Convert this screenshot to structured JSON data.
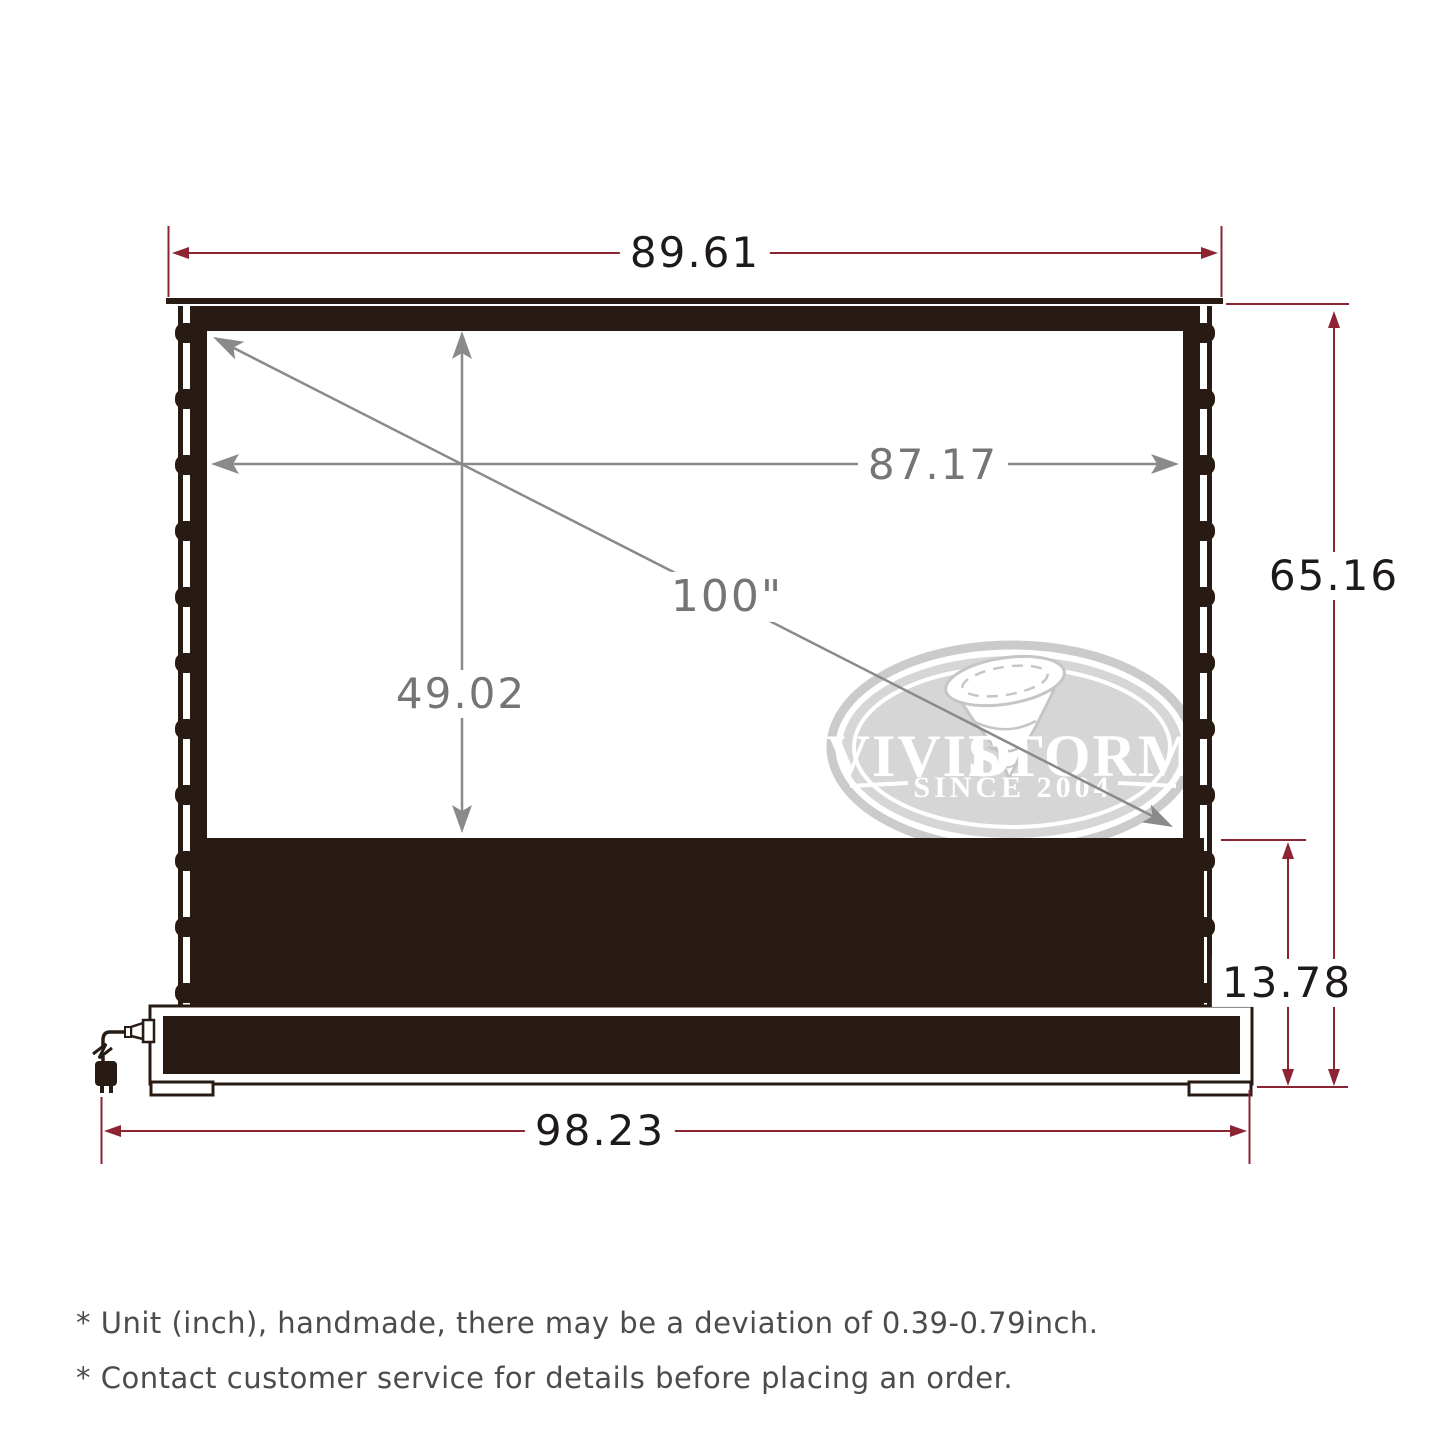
{
  "diagram": {
    "dims": {
      "housing_width": "89.61",
      "viewing_width": "87.17",
      "viewing_height": "49.02",
      "diagonal_size": "100\"",
      "overall_height": "65.16",
      "riser_height": "13.78",
      "base_width": "98.23"
    },
    "logo": {
      "brand_left": "VIVID",
      "brand_right": "STORM",
      "since": "SINCE 2004"
    },
    "footnotes": [
      "* Unit (inch), handmade, there may be a deviation of 0.39-0.79inch.",
      "* Contact customer service for details before placing an order."
    ],
    "colors": {
      "accent_red": "#8c2433",
      "dim_gray": "#8a8a8a",
      "frame_dark": "#281b14",
      "logo_gray": "#d6d6d6"
    }
  }
}
